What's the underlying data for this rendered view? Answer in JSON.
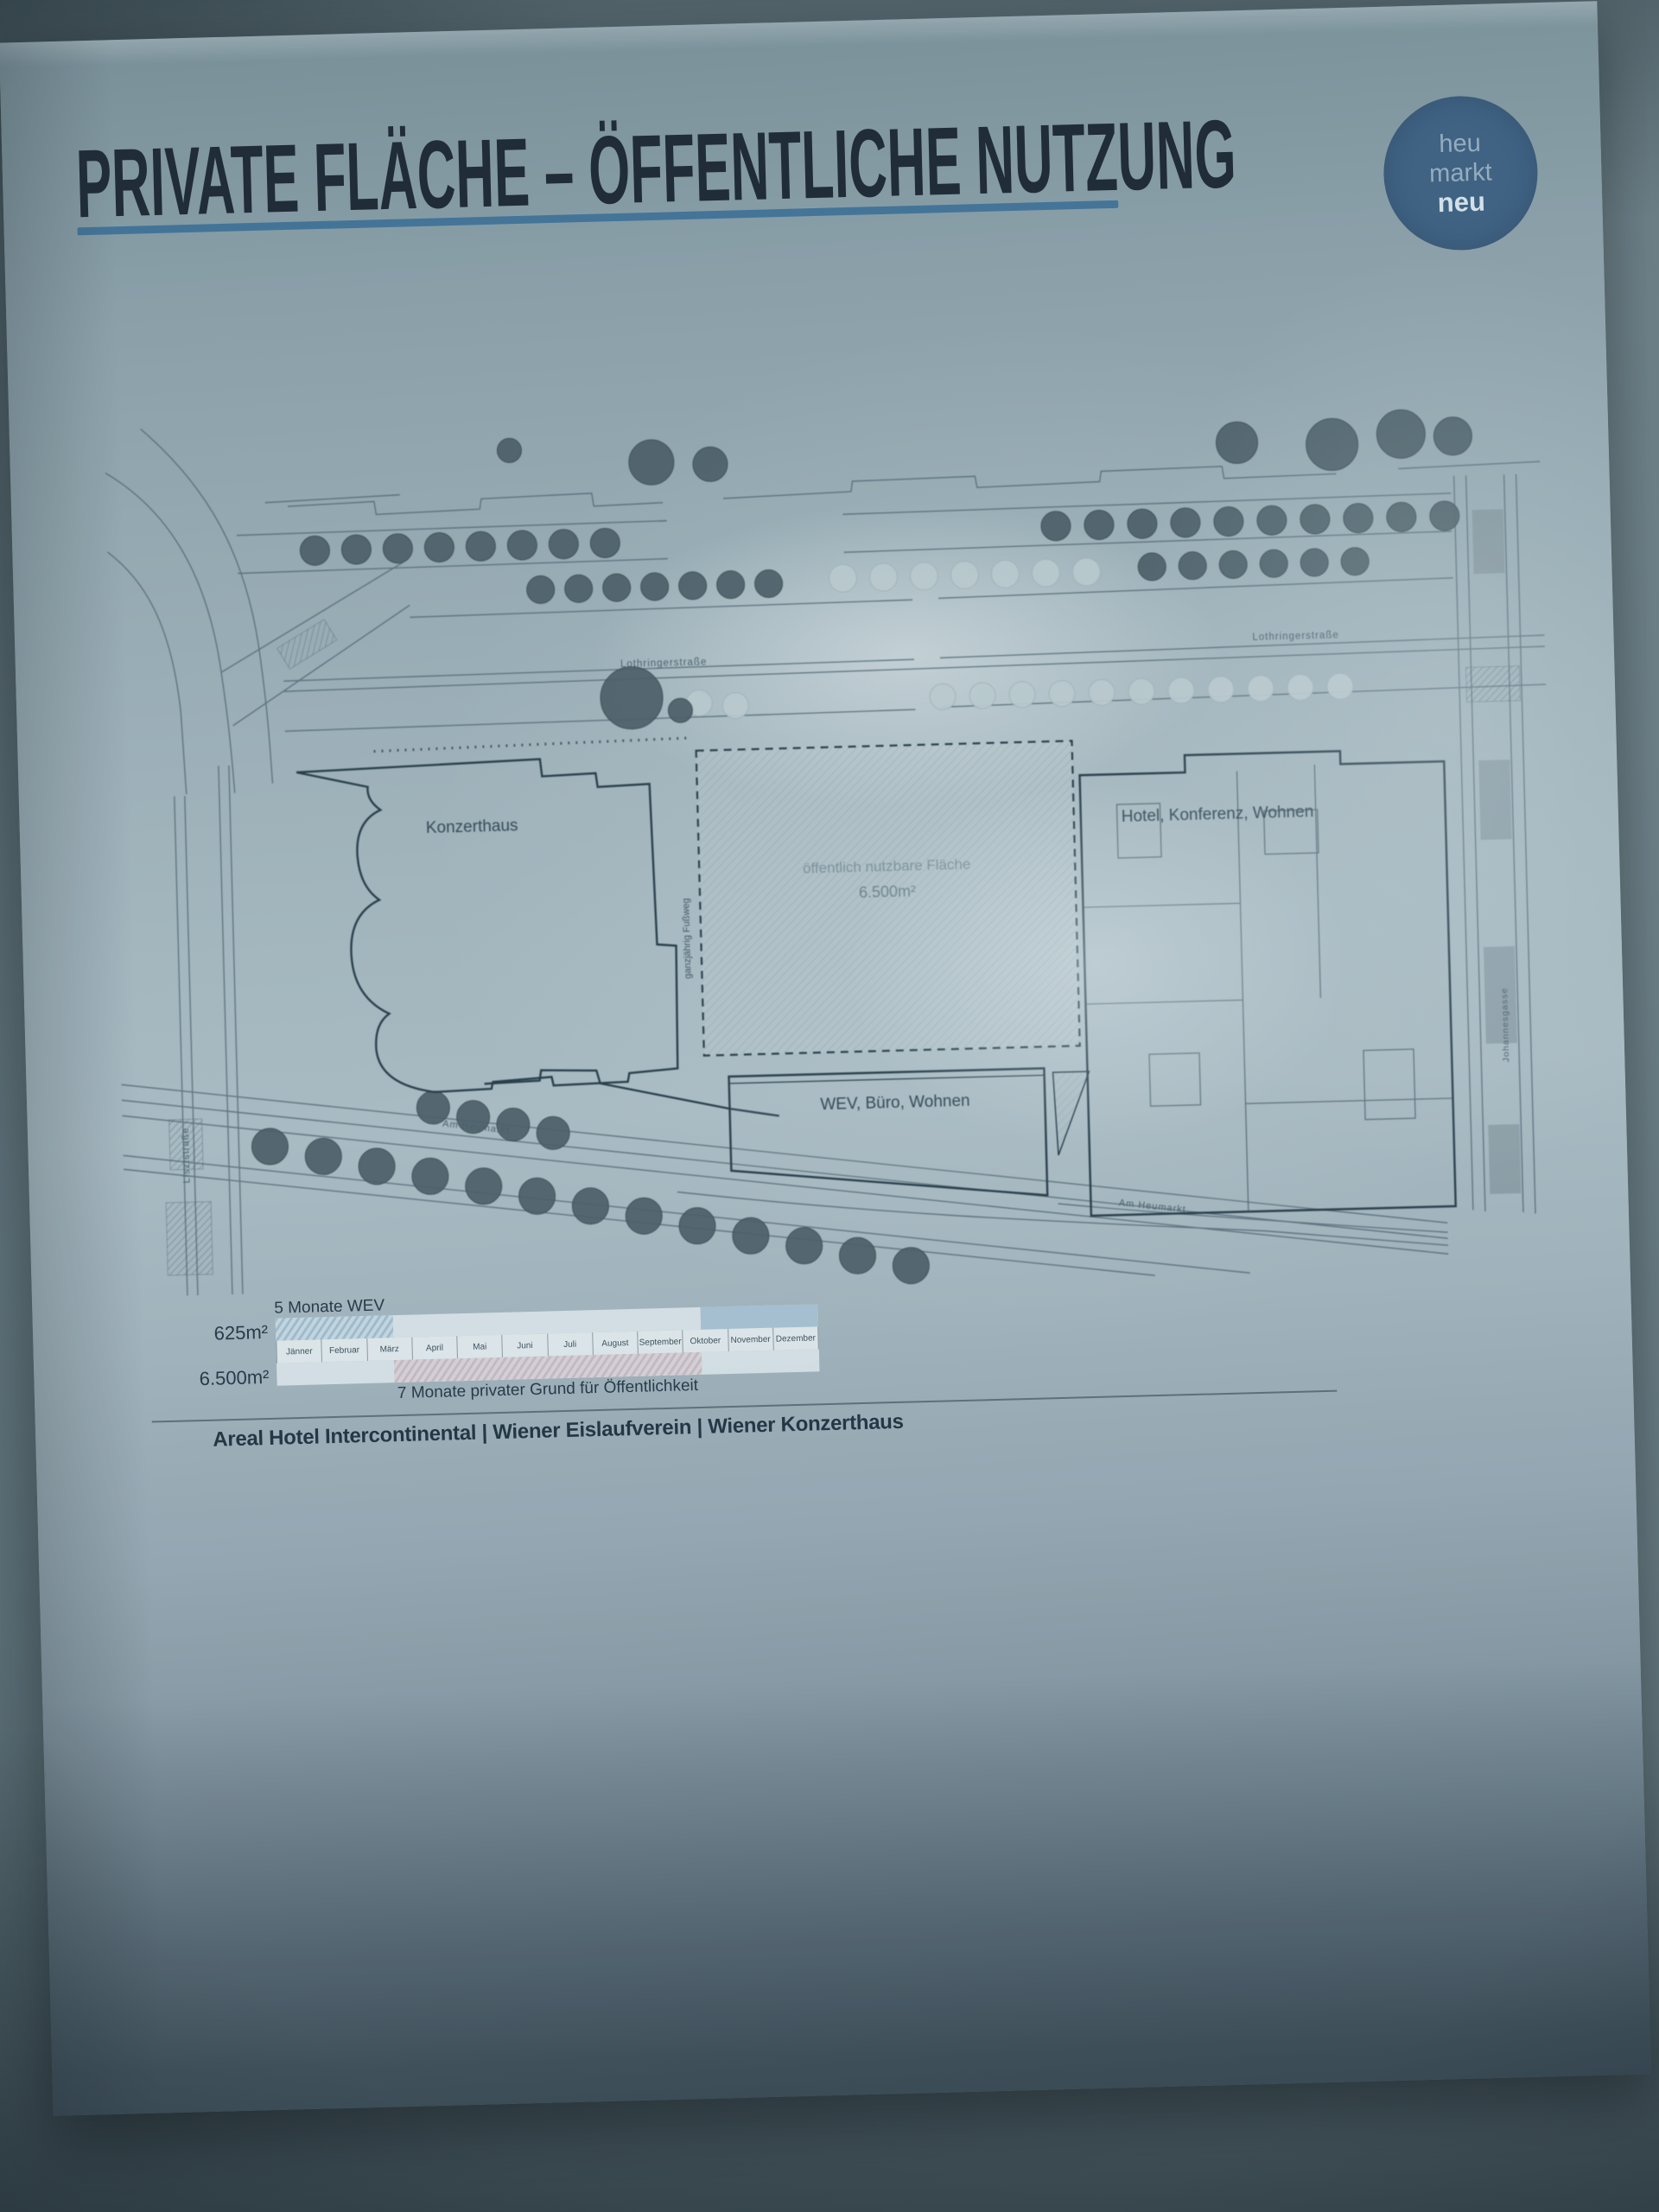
{
  "poster": {
    "title": "PRIVATE FLÄCHE – ÖFFENTLICHE NUTZUNG",
    "logo": {
      "line1": "heu",
      "line2": "markt",
      "line3": "neu"
    },
    "plan": {
      "building_labels": {
        "konzerthaus": "Konzerthaus",
        "hotel": "Hotel, Konferenz, Wohnen",
        "wev": "WEV, Büro, Wohnen"
      },
      "open_area": {
        "line1": "öffentlich nutzbare Fläche",
        "line2": "6.500m²"
      },
      "street_labels": {
        "lothringer_west": "Lothringerstraße",
        "lothringer_east": "Lothringerstraße",
        "am_heumarkt_west": "Am Heumarkt",
        "am_heumarkt_east": "Am Heumarkt",
        "liszt": "Lisztstraße",
        "johannesgasse": "Johannesgasse",
        "footpath": "ganzjährig Fußweg"
      }
    },
    "timeline": {
      "heading": "5 Monate WEV",
      "row1_area": "625m²",
      "row2_area": "6.500m²",
      "months": [
        "Jänner",
        "Februar",
        "März",
        "April",
        "Mai",
        "Juni",
        "Juli",
        "August",
        "September",
        "Oktober",
        "November",
        "Dezember"
      ],
      "note": "7 Monate privater Grund für Öffentlichkeit",
      "bars": {
        "row1_segments_months": [
          [
            0,
            2.6
          ],
          [
            9.4,
            12
          ]
        ],
        "row2_segments_months": [
          [
            2.6,
            9.4
          ]
        ]
      }
    },
    "footer": "Areal Hotel Intercontinental | Wiener Eislaufverein | Wiener Konzerthaus",
    "colors": {
      "title_ink": "#1c2a36",
      "underline": "#2f6f9e",
      "logo_circle": "#3a6389",
      "bar_blue": "#9dbdd2",
      "bar_pink": "#c4bcc6"
    }
  }
}
